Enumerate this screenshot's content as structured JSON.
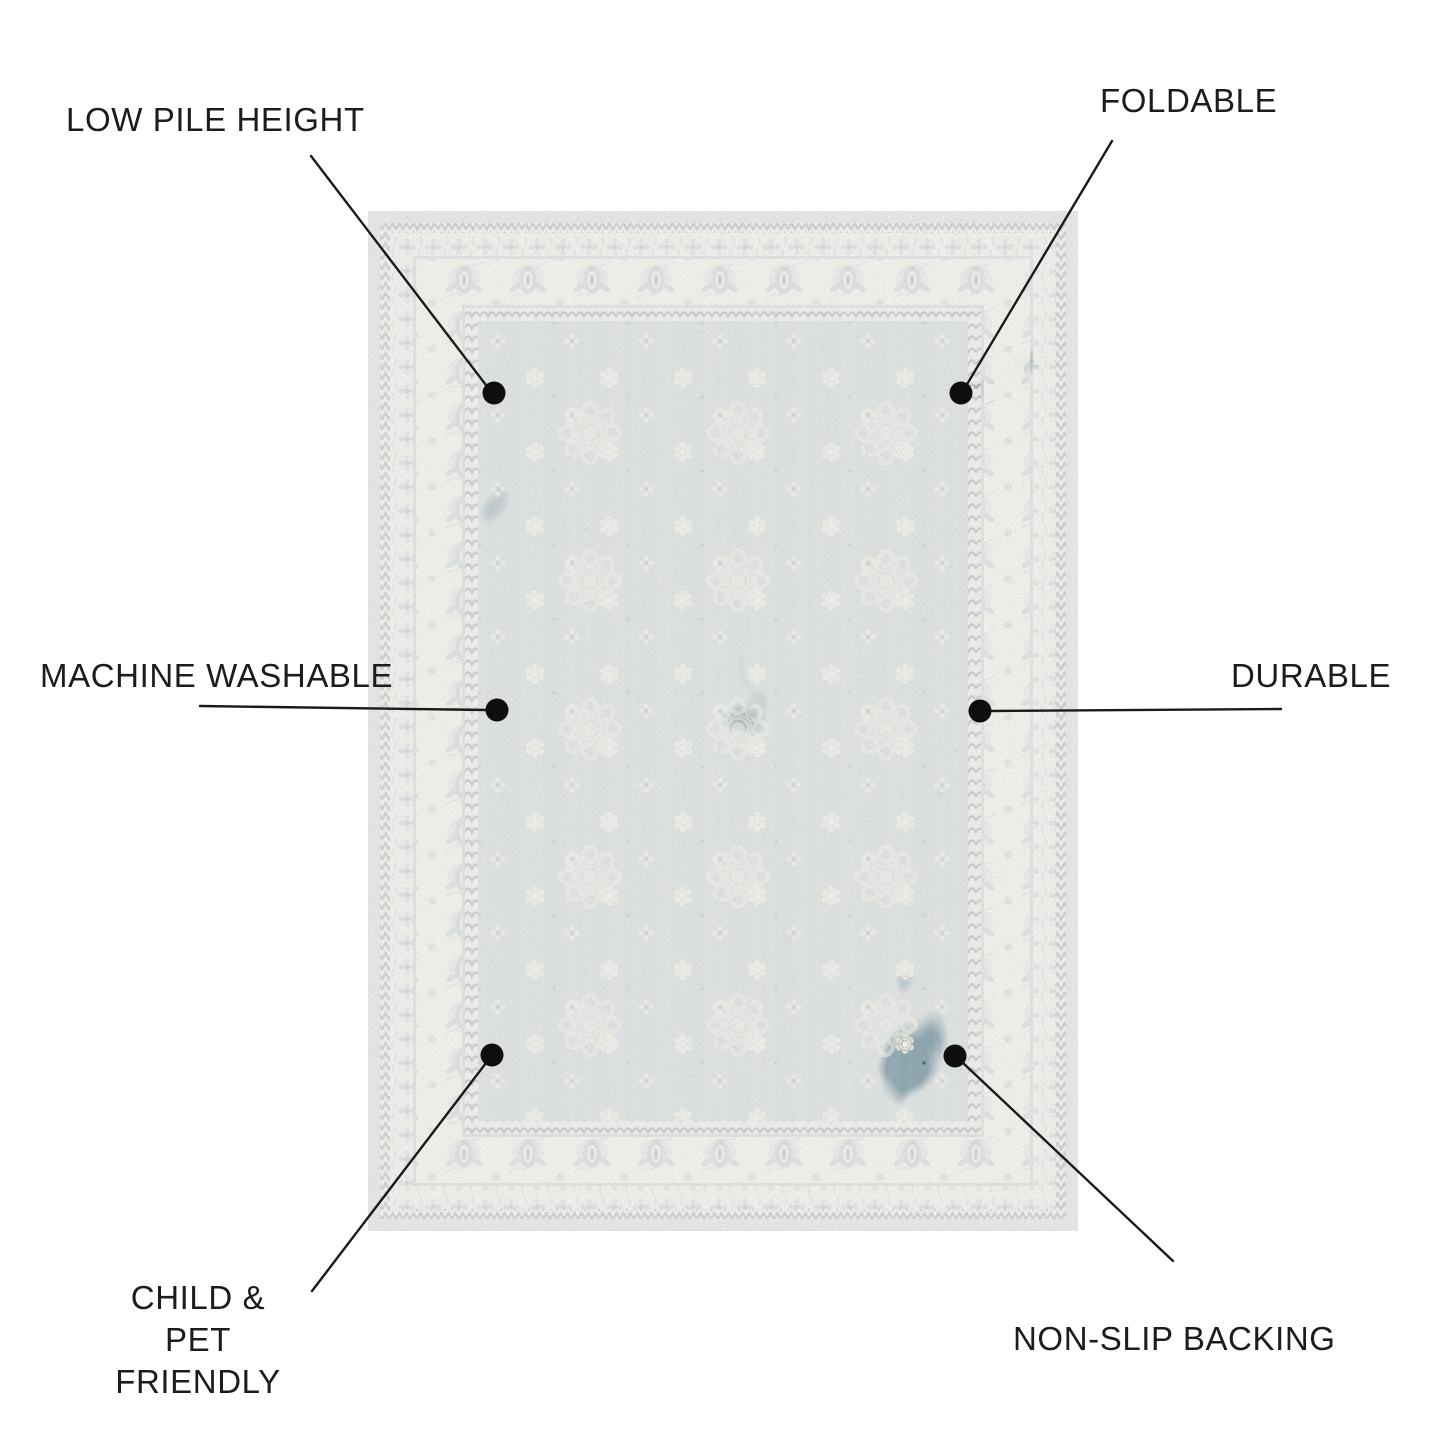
{
  "title": "Rug feature infographic",
  "features": [
    {
      "id": "low-pile-height",
      "label": "LOW PILE HEIGHT",
      "position": "top-left"
    },
    {
      "id": "foldable",
      "label": "FOLDABLE",
      "position": "top-right"
    },
    {
      "id": "machine-washable",
      "label": "MACHINE WASHABLE",
      "position": "middle-left"
    },
    {
      "id": "durable",
      "label": "DURABLE",
      "position": "middle-right"
    },
    {
      "id": "child-pet-friendly",
      "label": "CHILD & PET FRIENDLY",
      "lines": [
        "CHILD &",
        "PET FRIENDLY"
      ],
      "position": "bottom-left"
    },
    {
      "id": "non-slip-backing",
      "label": "NON-SLIP BACKING",
      "position": "bottom-right"
    }
  ],
  "annotation": {
    "dot_color": "#0e0e0e",
    "line_color": "#1a1a1a"
  },
  "rug": {
    "description": "vintage persian-style distressed rug, blue field with ivory floral borders",
    "colors": {
      "field": "#8fa6b0",
      "border_ivory": "#f2f0e8",
      "outer_band": "#b7c3c9",
      "navy_guard": "#33495c",
      "motif_blue": "#879dab",
      "cream_motif": "#e9e6d9"
    }
  }
}
